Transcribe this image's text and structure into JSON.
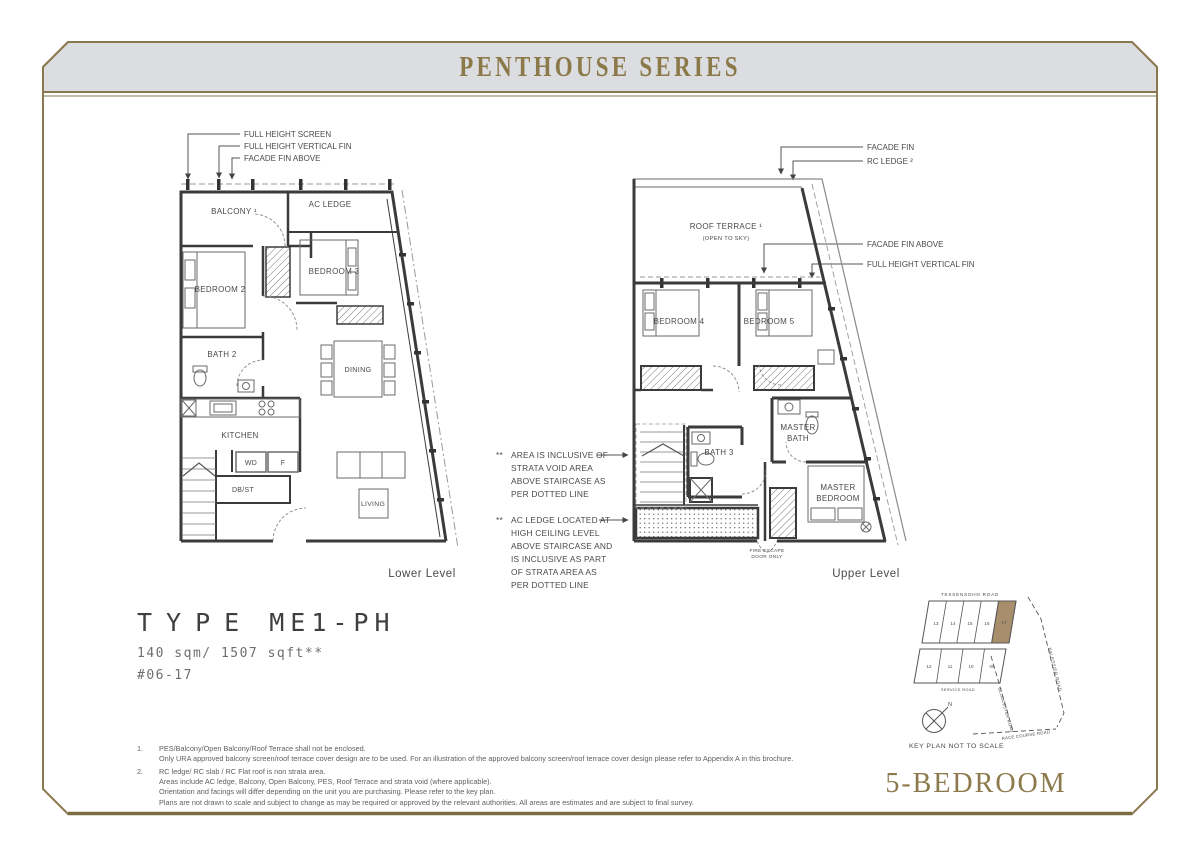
{
  "page": {
    "title": "PENTHOUSE SERIES",
    "series_label": "5-BEDROOM"
  },
  "unit": {
    "type_word": "TYPE",
    "type_code": "ME1-PH",
    "area": "140 sqm/ 1507 sqft**",
    "unit_no": "#06-17"
  },
  "lower_plan": {
    "caption": "Lower Level",
    "callouts": [
      "FULL HEIGHT SCREEN",
      "FULL HEIGHT VERTICAL FIN",
      "FACADE FIN ABOVE"
    ],
    "rooms": {
      "balcony": "BALCONY ¹",
      "ac_ledge": "AC LEDGE",
      "bedroom2": "BEDROOM 2",
      "bedroom3": "BEDROOM 3",
      "bath2": "BATH 2",
      "dining": "DINING",
      "kitchen": "KITCHEN",
      "wd": "WD",
      "f": "F",
      "dbst": "DB/ST",
      "living": "LIVING"
    }
  },
  "upper_plan": {
    "caption": "Upper Level",
    "callouts": [
      "FACADE FIN",
      "RC LEDGE ²",
      "FACADE FIN ABOVE",
      "FULL HEIGHT VERTICAL FIN"
    ],
    "rooms": {
      "roof_terrace": "ROOF TERRACE ¹",
      "open_to_sky": "(OPEN TO SKY)",
      "bedroom4": "BEDROOM 4",
      "bedroom5": "BEDROOM 5",
      "master_bath_l1": "MASTER",
      "master_bath_l2": "BATH",
      "bath3": "BATH 3",
      "master_bedroom_l1": "MASTER",
      "master_bedroom_l2": "BEDROOM",
      "fire_escape_l1": "FIRE ESCAPE",
      "fire_escape_l2": "DOOR ONLY"
    }
  },
  "annotations": {
    "strata_void": {
      "marker": "**",
      "lines": [
        "AREA IS INCLUSIVE OF",
        "STRATA VOID AREA",
        "ABOVE STAIRCASE AS",
        "PER DOTTED LINE"
      ]
    },
    "ac_ledge": {
      "marker": "**",
      "lines": [
        "AC LEDGE LOCATED AT",
        "HIGH CEILING LEVEL",
        "ABOVE STAIRCASE AND",
        "IS INCLUSIVE AS PART",
        "OF STRATA AREA AS",
        "PER DOTTED LINE"
      ]
    }
  },
  "keyplan": {
    "roads": {
      "top": "TESSENSOHN ROAD",
      "service": "SERVICE ROAD",
      "right": "BALESTIER ROAD",
      "left": "GLOUCESTER ROAD",
      "bottom": "RACE COURSE ROAD"
    },
    "blocks_top": [
      "13",
      "14",
      "15",
      "16",
      "17"
    ],
    "blocks_bottom": [
      "12",
      "11",
      "10",
      "09"
    ],
    "highlighted_block": "17",
    "compass_n": "N",
    "caption": "KEY PLAN NOT TO SCALE",
    "highlight_color": "#a98e6d"
  },
  "footnotes": [
    {
      "num": "1.",
      "lines": [
        "PES/Balcony/Open Balcony/Roof Terrace shall not be enclosed.",
        "Only URA approved balcony screen/roof terrace cover design are to be used. For an illustration of the approved balcony screen/roof terrace cover design please refer to Appendix A in this brochure."
      ]
    },
    {
      "num": "2.",
      "lines": [
        "RC ledge/ RC slab / RC Flat roof is non strata area.",
        "Areas include AC ledge, Balcony, Open Balcony, PES, Roof Terrace and strata void (where applicable).",
        "Orientation and facings will differ depending on the unit you are purchasing. Please refer to the key plan.",
        "Plans are not drawn to scale and subject to change as may be required or approved by the relevant authorities. All areas are estimates and are subject to final survey."
      ]
    }
  ],
  "colors": {
    "gold": "#8a7850",
    "band_bg": "#dcdde0",
    "wall": "#3a3a3a",
    "text": "#4a4a4a"
  }
}
